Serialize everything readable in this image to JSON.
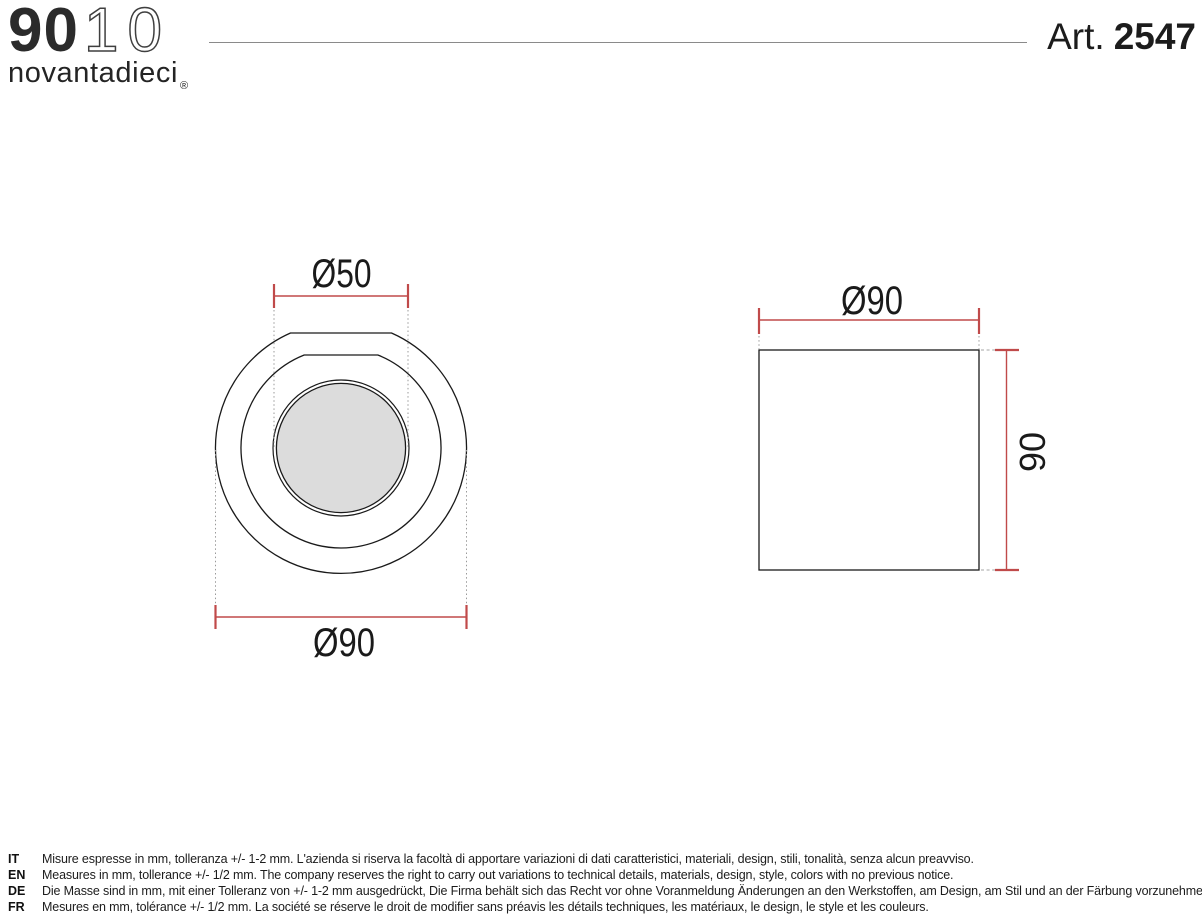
{
  "header": {
    "logo": {
      "bold": "90",
      "light": "10",
      "subtitle": "novantadieci",
      "registered": "®"
    },
    "article": {
      "label": "Art.",
      "number": "2547"
    }
  },
  "drawing": {
    "top_view": {
      "dim_inner": "Ø50",
      "dim_outer": "Ø90"
    },
    "side_view": {
      "dim_width": "Ø90",
      "dim_height": "90"
    }
  },
  "footer": {
    "notes": [
      {
        "lang": "IT",
        "text": "Misure espresse in mm, tolleranza +/- 1-2 mm. L'azienda si riserva la facoltà di apportare variazioni di dati caratteristici, materiali, design, stili, tonalità, senza alcun preavviso."
      },
      {
        "lang": "EN",
        "text": "Measures in mm, tollerance +/- 1/2 mm. The company reserves the right to carry out variations to technical details, materials, design, style, colors with no previous notice."
      },
      {
        "lang": "DE",
        "text": "Die Masse sind in mm, mit einer Tolleranz von +/- 1-2 mm ausgedrückt, Die Firma behält sich das Recht vor ohne Voranmeldung Änderungen an den Werkstoffen, am Design, am Stil und an der Färbung vorzunehmen."
      },
      {
        "lang": "FR",
        "text": "Mesures en mm, tolérance +/- 1/2 mm. La société se réserve le droit de modifier sans préavis les détails techniques, les matériaux, le design, le style et les couleurs."
      }
    ]
  },
  "colors": {
    "dimension_red": "#c04a4a",
    "drawing_line": "#1a1a1a",
    "lens_fill": "#dcdcdc",
    "dotted_gray": "#9a9a9a",
    "rule_gray": "#8a8a8a"
  }
}
